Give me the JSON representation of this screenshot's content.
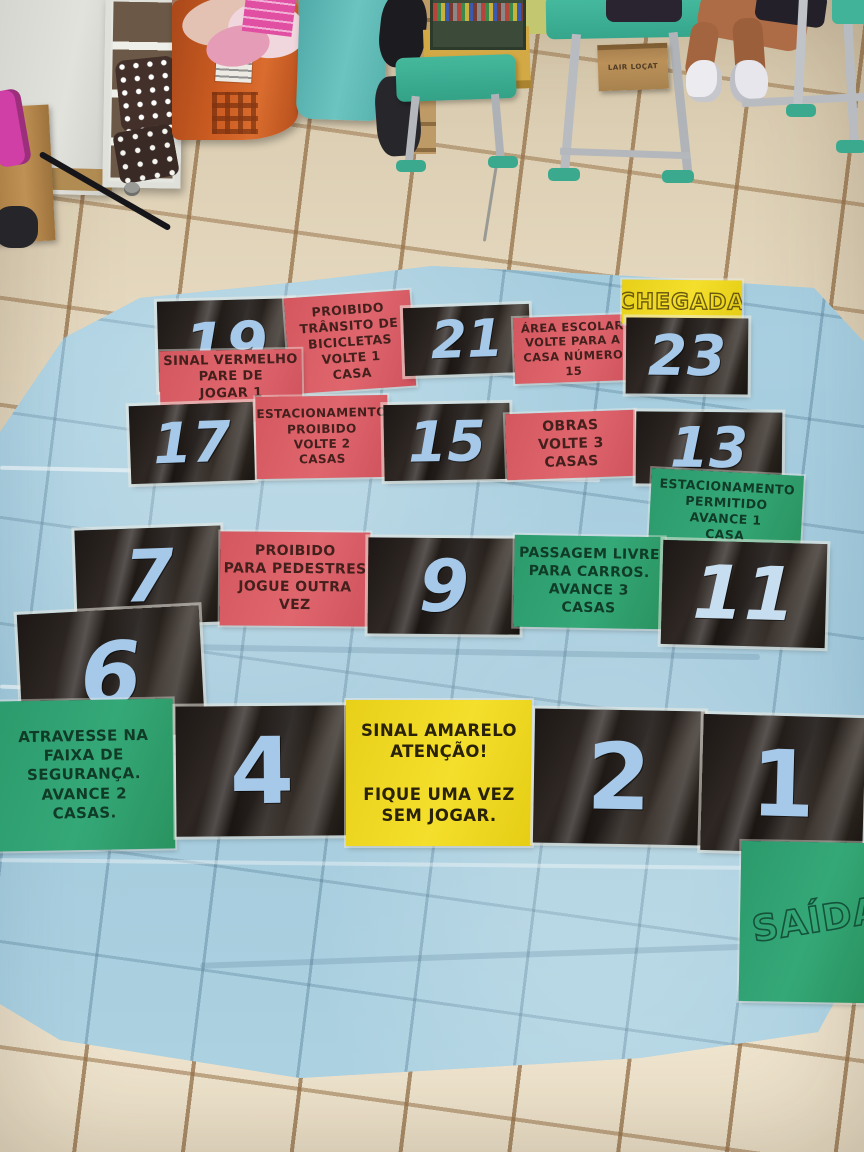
{
  "scene": {
    "room": {
      "box_label": "LAIR LOÇAT"
    }
  },
  "board": {
    "finish_label": "CHEGADA",
    "start_label": "SAÍDA",
    "numbers": {
      "c1": "1",
      "c2": "2",
      "c4": "4",
      "c6": "6",
      "c7": "7",
      "c9": "9",
      "c11": "11",
      "c13": "13",
      "c15": "15",
      "c17": "17",
      "c19": "19",
      "c21": "21",
      "c23": "23"
    },
    "cards": {
      "transito_bicicletas": "PROIBIDO\nTRÂNSITO DE\nBICICLETAS\nVOLTE 1\nCASA",
      "area_escolar": "ÁREA ESCOLAR\nVOLTE PARA A\nCASA NÚMERO\n15",
      "sinal_vermelho": "SINAL VERMELHO\nPARE DE\nJOGAR 1\nVEZ",
      "estacionamento_proibido": "ESTACIONAMENTO\nPROIBIDO\nVOLTE 2\nCASAS",
      "obras": "OBRAS\nVOLTE 3\nCASAS",
      "estacionamento_permitido": "ESTACIONAMENTO\nPERMITIDO\nAVANCE 1\nCASA",
      "proibido_pedestres": "PROIBIDO\nPARA PEDESTRES\nJOGUE OUTRA\nVEZ",
      "passagem_livre": "PASSAGEM LIVRE\nPARA CARROS.\nAVANCE 3\nCASAS",
      "atravesse_faixa": "ATRAVESSE NA\nFAIXA DE\nSEGURANÇA.\nAVANCE 2\nCASAS.",
      "sinal_amarelo": "SINAL AMARELO\nATENÇÃO!\n\nFIQUE UMA VEZ\nSEM JOGAR."
    },
    "colors": {
      "tarp_blue": "#a3cadc",
      "cell_black": "#1e1916",
      "card_pink": "#d85f68",
      "card_green": "#2fa172",
      "card_yellow": "#efd71f",
      "number_blue": "#a6c9ea"
    }
  }
}
